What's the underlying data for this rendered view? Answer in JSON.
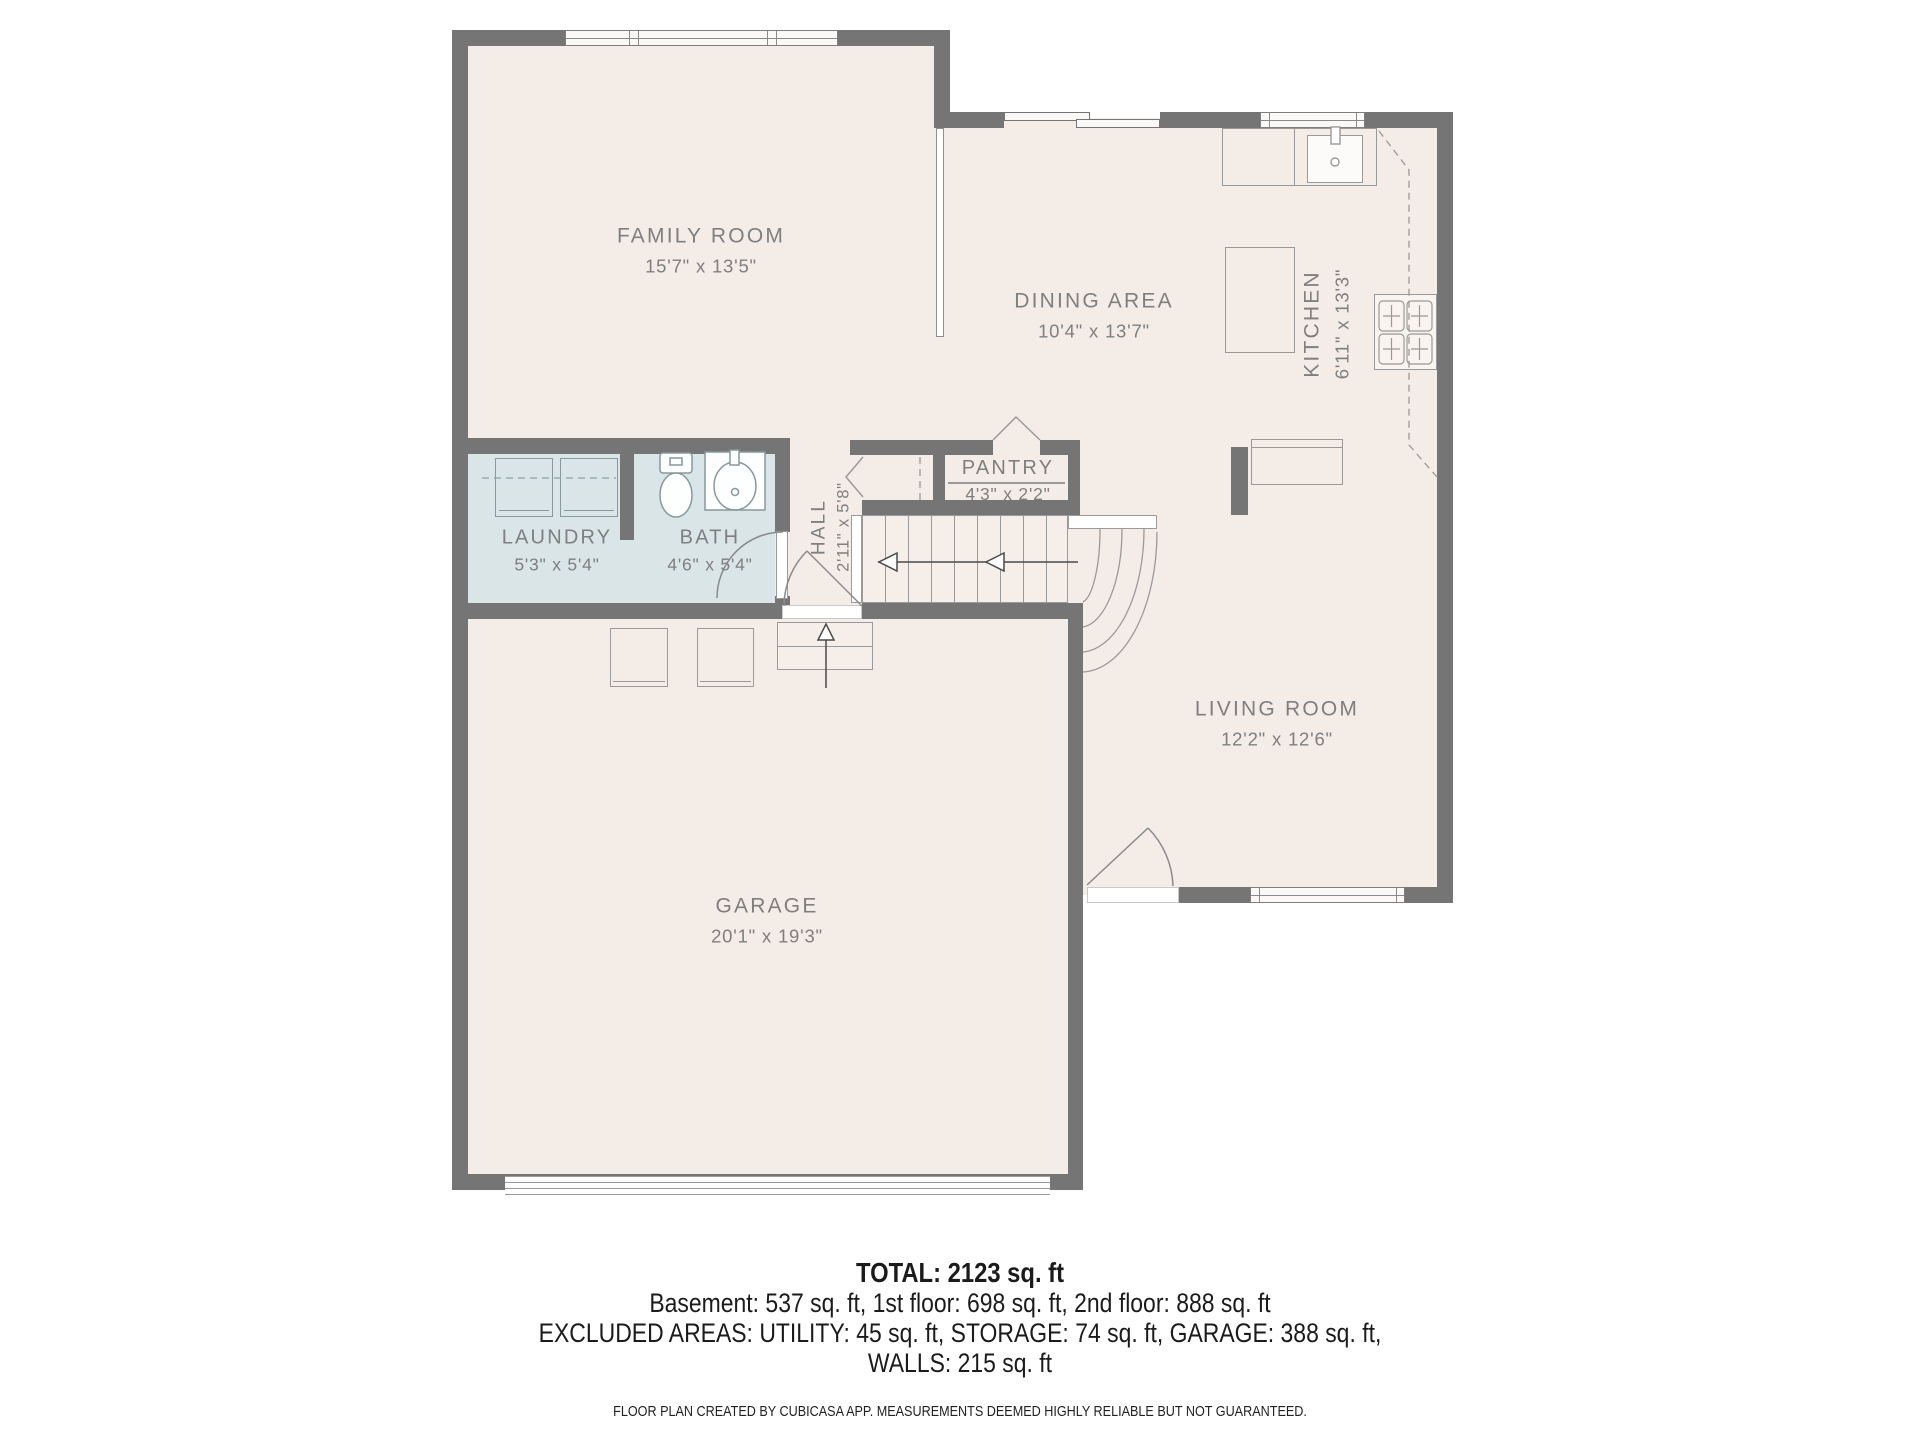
{
  "plan": {
    "rooms": [
      {
        "name": "FAMILY ROOM",
        "dims": "15'7\" x 13'5\""
      },
      {
        "name": "DINING AREA",
        "dims": "10'4\" x 13'7\""
      },
      {
        "name": "KITCHEN",
        "dims": "6'11\" x 13'3\""
      },
      {
        "name": "PANTRY",
        "dims": "4'3\" x 2'2\""
      },
      {
        "name": "LAUNDRY",
        "dims": "5'3\" x 5'4\""
      },
      {
        "name": "BATH",
        "dims": "4'6\" x 5'4\""
      },
      {
        "name": "HALL",
        "dims": "2'11\" x 5'8\""
      },
      {
        "name": "LIVING ROOM",
        "dims": "12'2\" x 12'6\""
      },
      {
        "name": "GARAGE",
        "dims": "20'1\" x 19'3\""
      }
    ],
    "colors": {
      "wall": "#757575",
      "floor": "#f4ece6",
      "wet_floor": "#d9e5e6",
      "label_text": "#7f7f7f",
      "footer_text": "#1b1b1b"
    },
    "icons": [
      "washer-icon",
      "dryer-icon",
      "toilet-icon",
      "sink-icon",
      "kitchen-sink-icon",
      "stove-icon",
      "stairs-up-arrow-icon",
      "door-swing-icon",
      "window-icon"
    ]
  },
  "footer": {
    "total": "TOTAL: 2123 sq. ft",
    "floors": "Basement: 537 sq. ft, 1st floor: 698 sq. ft, 2nd floor: 888 sq. ft",
    "excluded": "EXCLUDED AREAS: UTILITY: 45 sq. ft, STORAGE: 74 sq. ft, GARAGE: 388 sq. ft,",
    "walls": "WALLS: 215 sq. ft",
    "disclaimer": "FLOOR PLAN CREATED BY CUBICASA APP. MEASUREMENTS DEEMED HIGHLY RELIABLE BUT NOT GUARANTEED."
  }
}
